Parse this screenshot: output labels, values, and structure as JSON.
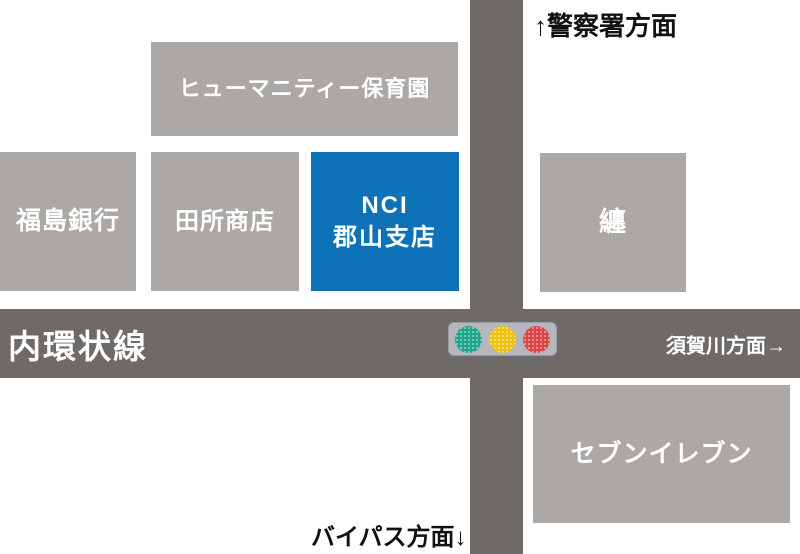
{
  "colors": {
    "building_gray": "#ABA8A6",
    "road_gray": "#6E6A68",
    "nci_blue": "#0E72B8",
    "traffic_body": "#B6B6BE",
    "signal_green": "#1BA78C",
    "signal_yellow": "#F2C40F",
    "signal_red": "#E04343",
    "text_white": "#FFFFFF",
    "text_black": "#111111"
  },
  "buildings": [
    {
      "name": "humanity-nursery",
      "label": "ヒューマニティー保育園"
    },
    {
      "name": "fukushima-bank",
      "label": "福島銀行"
    },
    {
      "name": "tadokoro-shoten",
      "label": "田所商店"
    },
    {
      "name": "nci-koriyama-branch",
      "label_line1": "NCI",
      "label_line2": "郡山支店"
    },
    {
      "name": "matoi",
      "label": "纏"
    },
    {
      "name": "seven-eleven",
      "label": "セブンイレブン"
    }
  ],
  "roads": {
    "horizontal_name": "内環状線",
    "direction_right": "須賀川方面→",
    "direction_top": "↑警察署方面",
    "direction_bottom": "バイパス方面↓"
  },
  "traffic_light": {
    "lights": [
      "green",
      "yellow",
      "red"
    ]
  }
}
